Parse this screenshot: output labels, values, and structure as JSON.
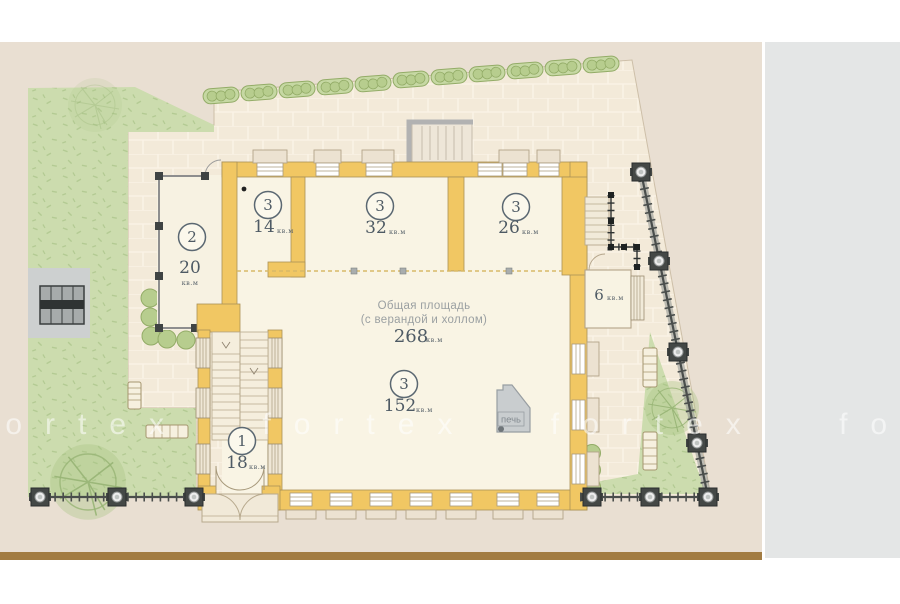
{
  "watermark": {
    "text": "fortex fortex fortex fortex"
  },
  "plan": {
    "summary": {
      "line1": "Общая площадь",
      "line2": "(с верандой и холлом)",
      "value": "268",
      "unit": "кв.м"
    },
    "rooms": [
      {
        "number": "2",
        "area": "20",
        "unit": "кв.м",
        "name": "veranda"
      },
      {
        "number": "3",
        "area": "14",
        "unit": "кв.м",
        "name": "room-14"
      },
      {
        "number": "3",
        "area": "32",
        "unit": "кв.м",
        "name": "room-32"
      },
      {
        "number": "3",
        "area": "26",
        "unit": "кв.м",
        "name": "room-26"
      },
      {
        "number": "3",
        "area": "152",
        "unit": "кв.м",
        "name": "main-hall"
      },
      {
        "number": "1",
        "area": "18",
        "unit": "кв.м",
        "name": "entrance-hall"
      },
      {
        "number": "",
        "area": "6",
        "unit": "кв.м",
        "name": "side-annex"
      }
    ],
    "stove_label": "печь"
  },
  "colors": {
    "panel_beige": "#e9dfd2",
    "paving": "#f3ead9",
    "lawn_green": "#ccdcae",
    "hedge_green": "#c6d8a3",
    "wall_yellow": "#f1c763",
    "floor_cream": "#f9f4e4",
    "fence_dark": "#3f4442",
    "label_slate": "#4e5a64",
    "stove_gray": "#c9cdcf",
    "bottom_bar_brown": "#a27c42",
    "side_strip_gray": "#e4e6e6"
  }
}
